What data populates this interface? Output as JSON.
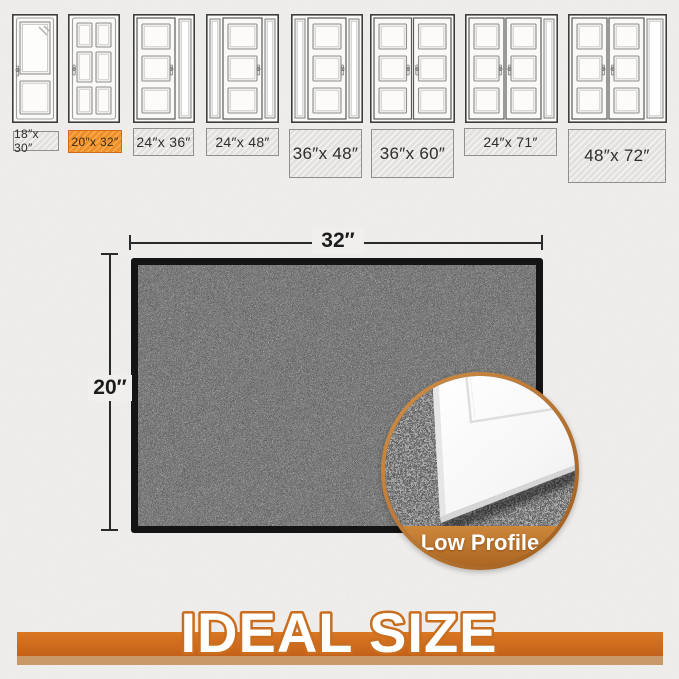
{
  "size_guide": {
    "items": [
      {
        "label": "18″x 30″",
        "door": "glass-single",
        "highlighted": false
      },
      {
        "label": "20″x 32″",
        "door": "six-panel",
        "highlighted": true
      },
      {
        "label": "24″x 36″",
        "door": "single-right-sidelite",
        "highlighted": false
      },
      {
        "label": "24″x 48″",
        "door": "single-two-sidelites",
        "highlighted": false
      },
      {
        "label": "36″x 48″",
        "door": "single-two-sidelites",
        "highlighted": false
      },
      {
        "label": "36″x 60″",
        "door": "double",
        "highlighted": false
      },
      {
        "label": "24″x 71″",
        "door": "double-right-sidelite",
        "highlighted": false
      },
      {
        "label": "48″x 72″",
        "door": "double-right-sidelite",
        "highlighted": false
      }
    ]
  },
  "mat_diagram": {
    "width_label": "32″",
    "height_label": "20″"
  },
  "inset": {
    "caption": "Low Profile"
  },
  "banner": {
    "title": "IDEAL SIZE"
  },
  "colors": {
    "highlight_orange": "#ee8f28",
    "banner_orange": "#d2701d",
    "banner_stripe": "#c9996a",
    "inset_ring": "#bf7a35",
    "mat_base": "#2f2f2f",
    "wall": "#f0efed"
  }
}
